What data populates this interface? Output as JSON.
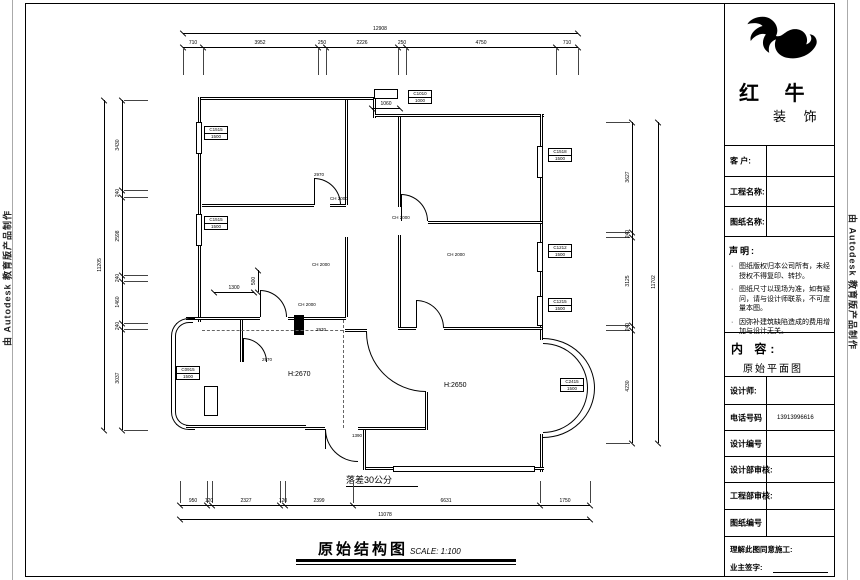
{
  "edges": {
    "autodesk": "由 Autodesk 教育版产品制作"
  },
  "titleblock": {
    "brand_l1": "红 牛",
    "brand_l2": "装 饰",
    "rows": {
      "customer": "客 户:",
      "project": "工程名称:",
      "drawing": "图纸名称:",
      "designer": "设计师:",
      "phone": "电话号码",
      "phone_value": "13913996616",
      "design_no": "设计编号",
      "design_review": "设计部审核:",
      "eng_review": "工程部审核:",
      "sheet_no": "图纸编号",
      "agree": "理解此图同意施工:",
      "owner_sign": "业主签字:"
    },
    "statement_heading": "声明:",
    "statement_bullet": "·",
    "statement_items": [
      "图纸版权归本公司所有，未经授权不得复印、转抄。",
      "图纸尺寸以现场为准，如有疑问，请与设计师联系，不可度量本图。",
      "因弥补建筑缺陷造成的费用增加与设计无关。"
    ],
    "content_heading": "内 容:",
    "content_value": "原始平面图"
  },
  "plan": {
    "title": "原始结构图",
    "scale": "SCALE: 1:100",
    "note_drop": "落差30公分",
    "gen_labels": [
      {
        "t": "H:2670",
        "x": 288,
        "y": 371,
        "s": 7
      },
      {
        "t": "H:2650",
        "x": 444,
        "y": 382,
        "s": 7
      },
      {
        "t": "CH 2000",
        "x": 330,
        "y": 196,
        "s": 4.5
      },
      {
        "t": "CH 2000",
        "x": 392,
        "y": 215,
        "s": 4.5
      },
      {
        "t": "CH 2000",
        "x": 447,
        "y": 252,
        "s": 4.5
      },
      {
        "t": "CH 2000",
        "x": 298,
        "y": 302,
        "s": 4.5
      },
      {
        "t": "CH 2000",
        "x": 312,
        "y": 262,
        "s": 4.5
      },
      {
        "t": "2970",
        "x": 314,
        "y": 172,
        "s": 4.5
      },
      {
        "t": "2970",
        "x": 316,
        "y": 327,
        "s": 4.5
      },
      {
        "t": "2970",
        "x": 262,
        "y": 357,
        "s": 4.5
      },
      {
        "t": "1390",
        "x": 352,
        "y": 433,
        "s": 4.5
      }
    ],
    "window_tags": [
      {
        "l1": "C1515",
        "l2": "1500",
        "x": 204,
        "y": 126
      },
      {
        "l1": "C1515",
        "l2": "1500",
        "x": 204,
        "y": 216
      },
      {
        "l1": "C1518",
        "l2": "1500",
        "x": 548,
        "y": 148
      },
      {
        "l1": "C1212",
        "l2": "1500",
        "x": 548,
        "y": 244
      },
      {
        "l1": "C1215",
        "l2": "1500",
        "x": 548,
        "y": 298
      },
      {
        "l1": "C1010",
        "l2": "1000",
        "x": 408,
        "y": 90
      },
      {
        "l1": "C2415",
        "l2": "1500",
        "x": 560,
        "y": 378
      },
      {
        "l1": "C0915",
        "l2": "1500",
        "x": 176,
        "y": 366
      }
    ]
  },
  "dims": {
    "chains": [
      {
        "name": "top-overall",
        "dir": "h",
        "x": 183,
        "y": 33,
        "len": 395,
        "ticks": [
          0,
          395
        ],
        "labels": [
          {
            "t": "12908",
            "c": 197
          }
        ]
      },
      {
        "name": "top-segments",
        "dir": "h",
        "x": 183,
        "y": 47,
        "len": 395,
        "ticks": [
          0,
          20,
          135,
          143,
          215,
          223,
          373,
          395
        ],
        "ext": {
          "len": 26,
          "side": 1
        },
        "labels": [
          {
            "t": "710",
            "c": 10
          },
          {
            "t": "3952",
            "c": 77
          },
          {
            "t": "250",
            "c": 139
          },
          {
            "t": "2226",
            "c": 179
          },
          {
            "t": "250",
            "c": 219
          },
          {
            "t": "4750",
            "c": 298
          },
          {
            "t": "710",
            "c": 384
          }
        ]
      },
      {
        "name": "left-overall",
        "dir": "v",
        "x": 104,
        "y": 100,
        "len": 330,
        "ticks": [
          0,
          330
        ],
        "labels": [
          {
            "t": "11205",
            "c": 165
          }
        ]
      },
      {
        "name": "left-segments",
        "dir": "v",
        "x": 122,
        "y": 100,
        "len": 330,
        "ticks": [
          0,
          90,
          97,
          175,
          181,
          223,
          229,
          330
        ],
        "ext": {
          "len": 24,
          "side": 1
        },
        "labels": [
          {
            "t": "3430",
            "c": 45
          },
          {
            "t": "240",
            "c": 93
          },
          {
            "t": "2598",
            "c": 136
          },
          {
            "t": "240",
            "c": 178
          },
          {
            "t": "1460",
            "c": 202
          },
          {
            "t": "240",
            "c": 226
          },
          {
            "t": "3037",
            "c": 278
          }
        ]
      },
      {
        "name": "right-segments",
        "dir": "v",
        "x": 632,
        "y": 122,
        "len": 321,
        "ticks": [
          0,
          110,
          115,
          203,
          208,
          321
        ],
        "ext": {
          "len": 24,
          "side": -1
        },
        "labels": [
          {
            "t": "3627",
            "c": 55
          },
          {
            "t": "240",
            "c": 112
          },
          {
            "t": "3125",
            "c": 159
          },
          {
            "t": "240",
            "c": 205
          },
          {
            "t": "4230",
            "c": 264
          }
        ]
      },
      {
        "name": "right-overall",
        "dir": "v",
        "x": 658,
        "y": 122,
        "len": 321,
        "ticks": [
          0,
          321
        ],
        "labels": [
          {
            "t": "11702",
            "c": 160
          }
        ]
      },
      {
        "name": "bottom-segments",
        "dir": "h",
        "x": 180,
        "y": 505,
        "len": 410,
        "ticks": [
          0,
          27,
          32,
          100,
          105,
          173,
          360,
          410
        ],
        "ext": {
          "len": 22,
          "side": -1
        },
        "labels": [
          {
            "t": "950",
            "c": 13
          },
          {
            "t": "120",
            "c": 29
          },
          {
            "t": "2327",
            "c": 66
          },
          {
            "t": "120",
            "c": 103
          },
          {
            "t": "2399",
            "c": 139
          },
          {
            "t": "6631",
            "c": 266
          },
          {
            "t": "1750",
            "c": 385
          }
        ]
      },
      {
        "name": "bottom-overall",
        "dir": "h",
        "x": 180,
        "y": 519,
        "len": 410,
        "ticks": [
          0,
          410
        ],
        "labels": [
          {
            "t": "11078",
            "c": 205
          }
        ]
      },
      {
        "name": "dim-1300",
        "dir": "h",
        "x": 214,
        "y": 292,
        "len": 40,
        "ticks": [
          0,
          40
        ],
        "labels": [
          {
            "t": "1300",
            "c": 20
          }
        ]
      },
      {
        "name": "dim-500",
        "dir": "v",
        "x": 258,
        "y": 270,
        "len": 22,
        "ticks": [
          0,
          22
        ],
        "labels": [
          {
            "t": "500",
            "c": 11
          }
        ]
      },
      {
        "name": "dim-1060",
        "dir": "h",
        "x": 372,
        "y": 108,
        "len": 28,
        "ticks": [
          0,
          28
        ],
        "labels": [
          {
            "t": "1060",
            "c": 14
          }
        ]
      }
    ]
  }
}
